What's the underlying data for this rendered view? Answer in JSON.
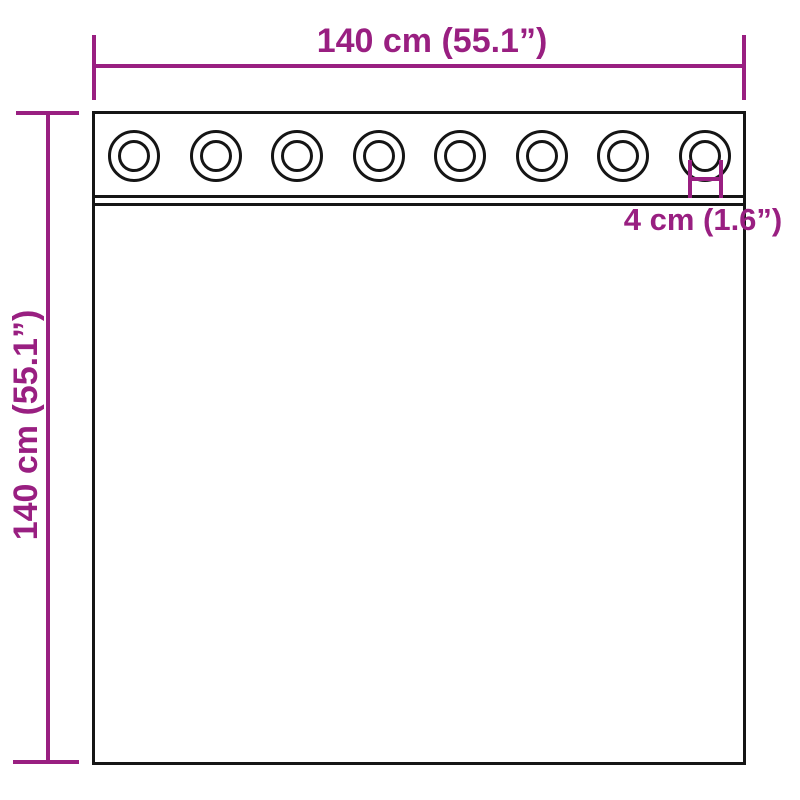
{
  "diagram": {
    "width_dimension": {
      "label": "140 cm (55.1”)"
    },
    "height_dimension": {
      "label": "140 cm (55.1”)"
    },
    "grommet_dimension": {
      "label": "4 cm (1.6”)"
    },
    "curtain": {
      "grommet_count": 8
    },
    "colors": {
      "accent": "#991F81",
      "line": "#151515",
      "background": "#FFFFFF"
    }
  }
}
